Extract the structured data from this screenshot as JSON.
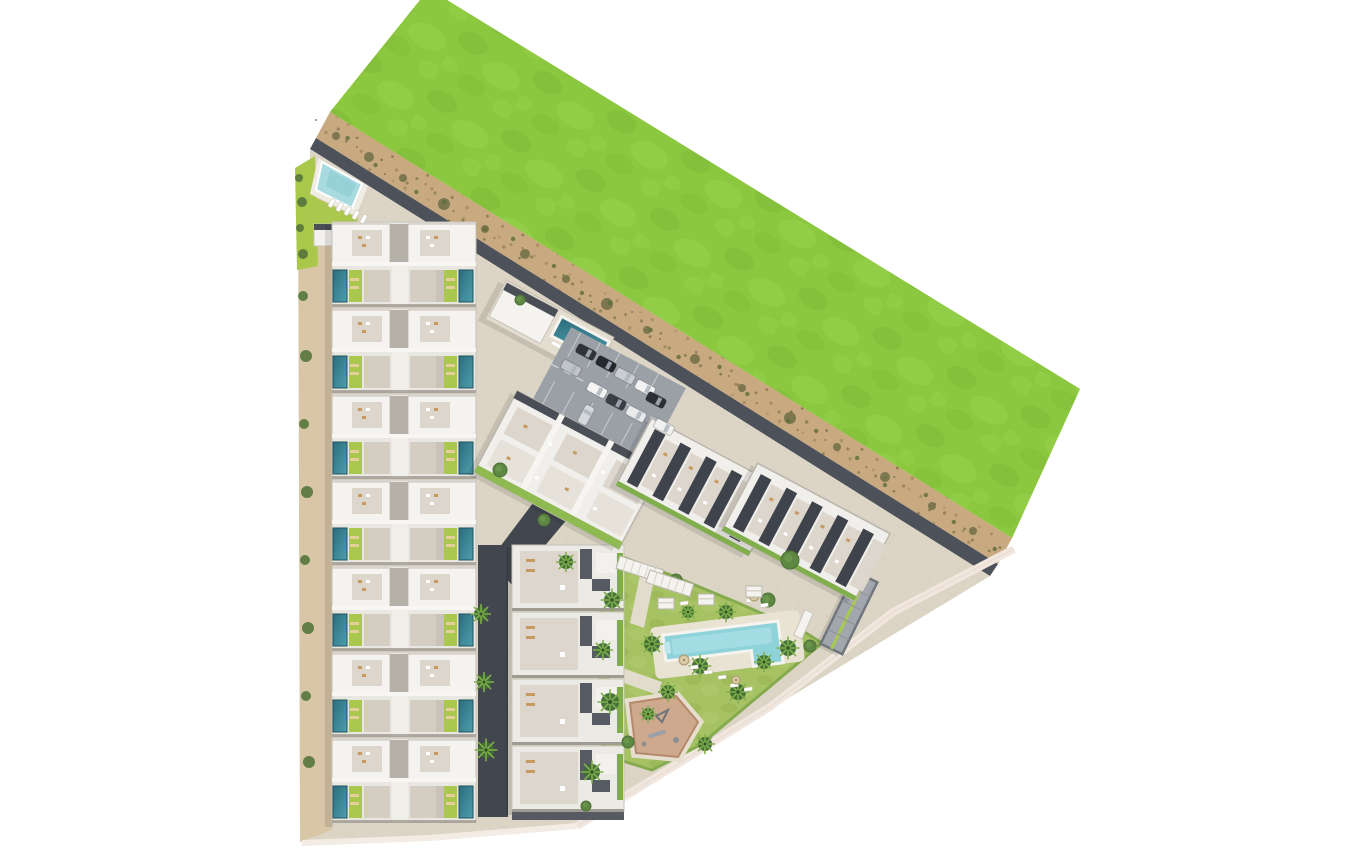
{
  "scene": {
    "type": "aerial-3d-masterplan-render",
    "setting": "residential development beside an open green field",
    "regions": {
      "green_field": "open grass field",
      "sand_path": "sandy buffer strip with shrubs",
      "perimeter_road": "perimeter road",
      "townhouse_rows": "double row of townhouses with private pools",
      "north_amenity": "corner communal pool and sun deck",
      "clubhouse": "clubhouse with lap pool",
      "parking": "surface parking lot",
      "central_block": "angled apartment block",
      "east_blocks": "angled apartment blocks with rooftop solar",
      "south_block": "south apartment row with roof terraces",
      "garden": "central landscaped garden",
      "main_pool": "communal swimming pool",
      "playground": "children playground",
      "ramp": "underground parking ramp",
      "street": "internal street with palms"
    },
    "counts": {
      "townhouse_clusters": 7,
      "south_block_units": 4,
      "angled_blocks": 3,
      "parked_cars": 11,
      "palm_trees": 18,
      "communal_pools": 3,
      "playgrounds": 1
    }
  },
  "palette": {
    "page": "#ffffff",
    "grass": "#8cc83f",
    "grass_light": "#9ad453",
    "grass_dark": "#7cb837",
    "sand": "#c9aa80",
    "sand_dark": "#a98f63",
    "road": "#4d525a",
    "street": "#42474f",
    "asphalt": "#9aa0a6",
    "ground": "#dcd5c6",
    "plaza": "#e3ddcf",
    "roof": "#f4f3ef",
    "roof_base": "#e9e7e1",
    "roof_stroke": "#c6c2b9",
    "terrace": "#dcd6cc",
    "patio": "#d3cdc2",
    "spine": "#f1efe9",
    "gray_mid": "#b6b1a8",
    "divider": "#a09b92",
    "dark_wall": "#565b63",
    "solar": "#3f444c",
    "lime": "#abc84e",
    "hedge": "#7fae4a",
    "lawn": "#a7c263",
    "pool_deep": "#2c6c7c",
    "pool_light": "#4d9fae",
    "pool_comm": "#a8dbe0",
    "pool_main": "#8ed2da",
    "pool_main_light": "#ace0e6",
    "palm": "#3f6d33",
    "palm_light": "#7fae4a",
    "tree": "#5d8742",
    "bush": "#55743c",
    "playground_fill": "#cfa98e",
    "playground_border": "#b5886b",
    "boundary": "#f1e7df",
    "furniture_tan": "#c99a5f",
    "lounger": "#e3cf9a"
  },
  "layout": {
    "left_block": {
      "x": 332,
      "y": 222,
      "w": 144,
      "cluster_h": 86,
      "clusters": 7
    },
    "mid_block": {
      "x": 512,
      "y": 545,
      "w": 112,
      "cluster_h": 67,
      "clusters": 4
    },
    "angled_blocks": [
      {
        "cx": 568,
        "cy": 470,
        "w": 164,
        "h": 92,
        "rot": 28,
        "style": "terrace"
      },
      {
        "cx": 700,
        "cy": 487,
        "w": 150,
        "h": 76,
        "rot": 28,
        "style": "solar"
      },
      {
        "cx": 806,
        "cy": 532,
        "w": 150,
        "h": 76,
        "rot": 28,
        "style": "solar"
      }
    ],
    "palms": [
      [
        481,
        614,
        7
      ],
      [
        484,
        682,
        7
      ],
      [
        486,
        750,
        8
      ],
      [
        612,
        600,
        8
      ],
      [
        603,
        650,
        7
      ],
      [
        610,
        702,
        9
      ],
      [
        592,
        772,
        8
      ],
      [
        652,
        644,
        8
      ],
      [
        668,
        692,
        7
      ],
      [
        700,
        666,
        8
      ],
      [
        738,
        692,
        8
      ],
      [
        705,
        744,
        7
      ],
      [
        764,
        662,
        7
      ],
      [
        788,
        648,
        8
      ],
      [
        726,
        612,
        7
      ],
      [
        688,
        612,
        6
      ],
      [
        648,
        714,
        6
      ],
      [
        566,
        562,
        7
      ]
    ],
    "trees": [
      [
        790,
        560,
        9
      ],
      [
        768,
        600,
        7
      ],
      [
        676,
        580,
        6
      ],
      [
        628,
        566,
        5
      ],
      [
        810,
        646,
        6
      ],
      [
        628,
        742,
        6
      ],
      [
        586,
        806,
        5
      ],
      [
        544,
        520,
        6
      ],
      [
        500,
        470,
        7
      ],
      [
        520,
        300,
        5
      ]
    ],
    "bushes_left": [
      [
        303,
        296,
        5
      ],
      [
        306,
        356,
        6
      ],
      [
        304,
        424,
        5
      ],
      [
        307,
        492,
        6
      ],
      [
        305,
        560,
        5
      ],
      [
        308,
        628,
        6
      ],
      [
        306,
        696,
        5
      ],
      [
        309,
        762,
        6
      ],
      [
        299,
        178,
        4
      ],
      [
        302,
        202,
        5
      ],
      [
        300,
        228,
        4
      ],
      [
        303,
        254,
        5
      ]
    ],
    "bushes_sand": [
      [
        336,
        136,
        4
      ],
      [
        369,
        157,
        5
      ],
      [
        403,
        178,
        4
      ],
      [
        444,
        204,
        6
      ],
      [
        485,
        229,
        4
      ],
      [
        525,
        254,
        5
      ],
      [
        566,
        279,
        4
      ],
      [
        607,
        304,
        6
      ],
      [
        647,
        330,
        4
      ],
      [
        695,
        359,
        5
      ],
      [
        742,
        388,
        4
      ],
      [
        790,
        418,
        6
      ],
      [
        837,
        447,
        4
      ],
      [
        885,
        477,
        5
      ],
      [
        932,
        506,
        4
      ],
      [
        973,
        531,
        4
      ]
    ],
    "cars": [
      {
        "x": 586,
        "y": 352,
        "r": 118,
        "c": "#2f3338"
      },
      {
        "x": 606,
        "y": 364,
        "r": 118,
        "c": "#24272b"
      },
      {
        "x": 625,
        "y": 376,
        "r": 118,
        "c": "#caced2"
      },
      {
        "x": 645,
        "y": 388,
        "r": 118,
        "c": "#f2f2f2"
      },
      {
        "x": 571,
        "y": 368,
        "r": 118,
        "c": "#c0c4c8"
      },
      {
        "x": 597,
        "y": 390,
        "r": 118,
        "c": "#f4f4f2"
      },
      {
        "x": 616,
        "y": 402,
        "r": 118,
        "c": "#3a3f45"
      },
      {
        "x": 636,
        "y": 414,
        "r": 118,
        "c": "#e8eaec"
      },
      {
        "x": 656,
        "y": 400,
        "r": 118,
        "c": "#2c3035"
      },
      {
        "x": 664,
        "y": 427,
        "r": 118,
        "c": "#f0f0ee"
      },
      {
        "x": 586,
        "y": 415,
        "r": 28,
        "c": "#d6d9dc"
      }
    ],
    "pool_loungers": [
      [
        690,
        666
      ],
      [
        704,
        671
      ],
      [
        718,
        676
      ],
      [
        746,
        599
      ],
      [
        760,
        604
      ],
      [
        680,
        602
      ],
      [
        730,
        684
      ],
      [
        744,
        688
      ]
    ],
    "parasols": [
      [
        684,
        660,
        5
      ],
      [
        754,
        596,
        5
      ],
      [
        736,
        680,
        4
      ]
    ],
    "cabanas": [
      [
        698,
        594
      ],
      [
        746,
        586
      ],
      [
        658,
        598
      ]
    ],
    "pergolas": [
      [
        620,
        556
      ],
      [
        650,
        570
      ]
    ],
    "deck_loungers": [
      [
        332,
        198
      ],
      [
        340,
        202
      ],
      [
        348,
        206
      ],
      [
        356,
        210
      ],
      [
        364,
        214
      ]
    ]
  }
}
